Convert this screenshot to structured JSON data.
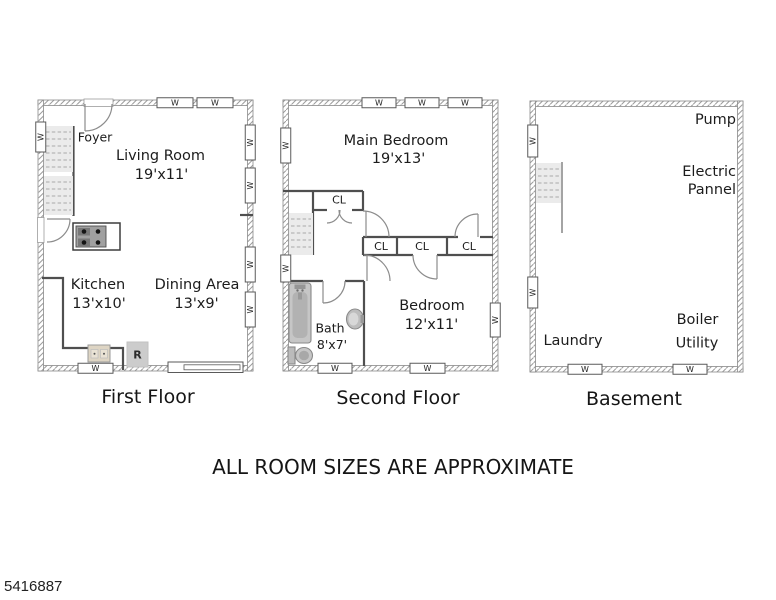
{
  "plans": {
    "first": {
      "title": "First Floor",
      "rooms": {
        "foyer": {
          "name": "Foyer"
        },
        "living_room": {
          "name": "Living Room",
          "size": "19'x11'"
        },
        "kitchen": {
          "name": "Kitchen",
          "size": "13'x10'"
        },
        "dining_area": {
          "name": "Dining Area",
          "size": "13'x9'"
        }
      },
      "fixtures": {
        "refrigerator": "R"
      }
    },
    "second": {
      "title": "Second Floor",
      "rooms": {
        "main_bedroom": {
          "name": "Main Bedroom",
          "size": "19'x13'"
        },
        "bedroom": {
          "name": "Bedroom",
          "size": "12'x11'"
        },
        "bath": {
          "name": "Bath",
          "size": "8'x7'"
        }
      }
    },
    "basement": {
      "title": "Basement",
      "areas": {
        "pump": "Pump",
        "electric_line1": "Electric",
        "electric_line2": "Pannel",
        "laundry": "Laundry",
        "boiler": "Boiler",
        "utility": "Utility"
      }
    }
  },
  "symbols": {
    "window": "W",
    "closet": "CL"
  },
  "footer": {
    "disclaimer": "ALL ROOM SIZES ARE APPROXIMATE",
    "listing_id": "5416887"
  },
  "colors": {
    "wall_hatch": "#9c9c9c",
    "text": "#1c1c1c",
    "fixture_gray": "#c2c2c2"
  }
}
